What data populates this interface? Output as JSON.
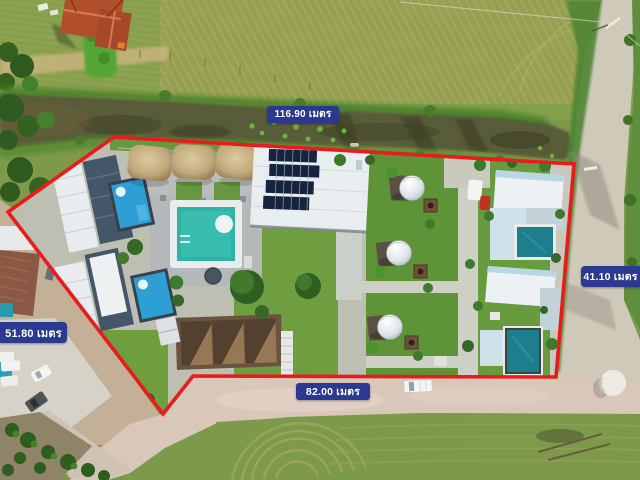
{
  "title": "Aerial land-plot photo with boundary measurements",
  "badges": {
    "top": {
      "label": "116.90 เมตร"
    },
    "right": {
      "label": "41.10 เมตร"
    },
    "bottom": {
      "label": "82.00 เมตร"
    },
    "left": {
      "label": "51.80 เมตร"
    }
  },
  "colors": {
    "badge_bg": "#2b3a90",
    "badge_text": "#ffffff",
    "boundary_red": "#e81c1c"
  }
}
